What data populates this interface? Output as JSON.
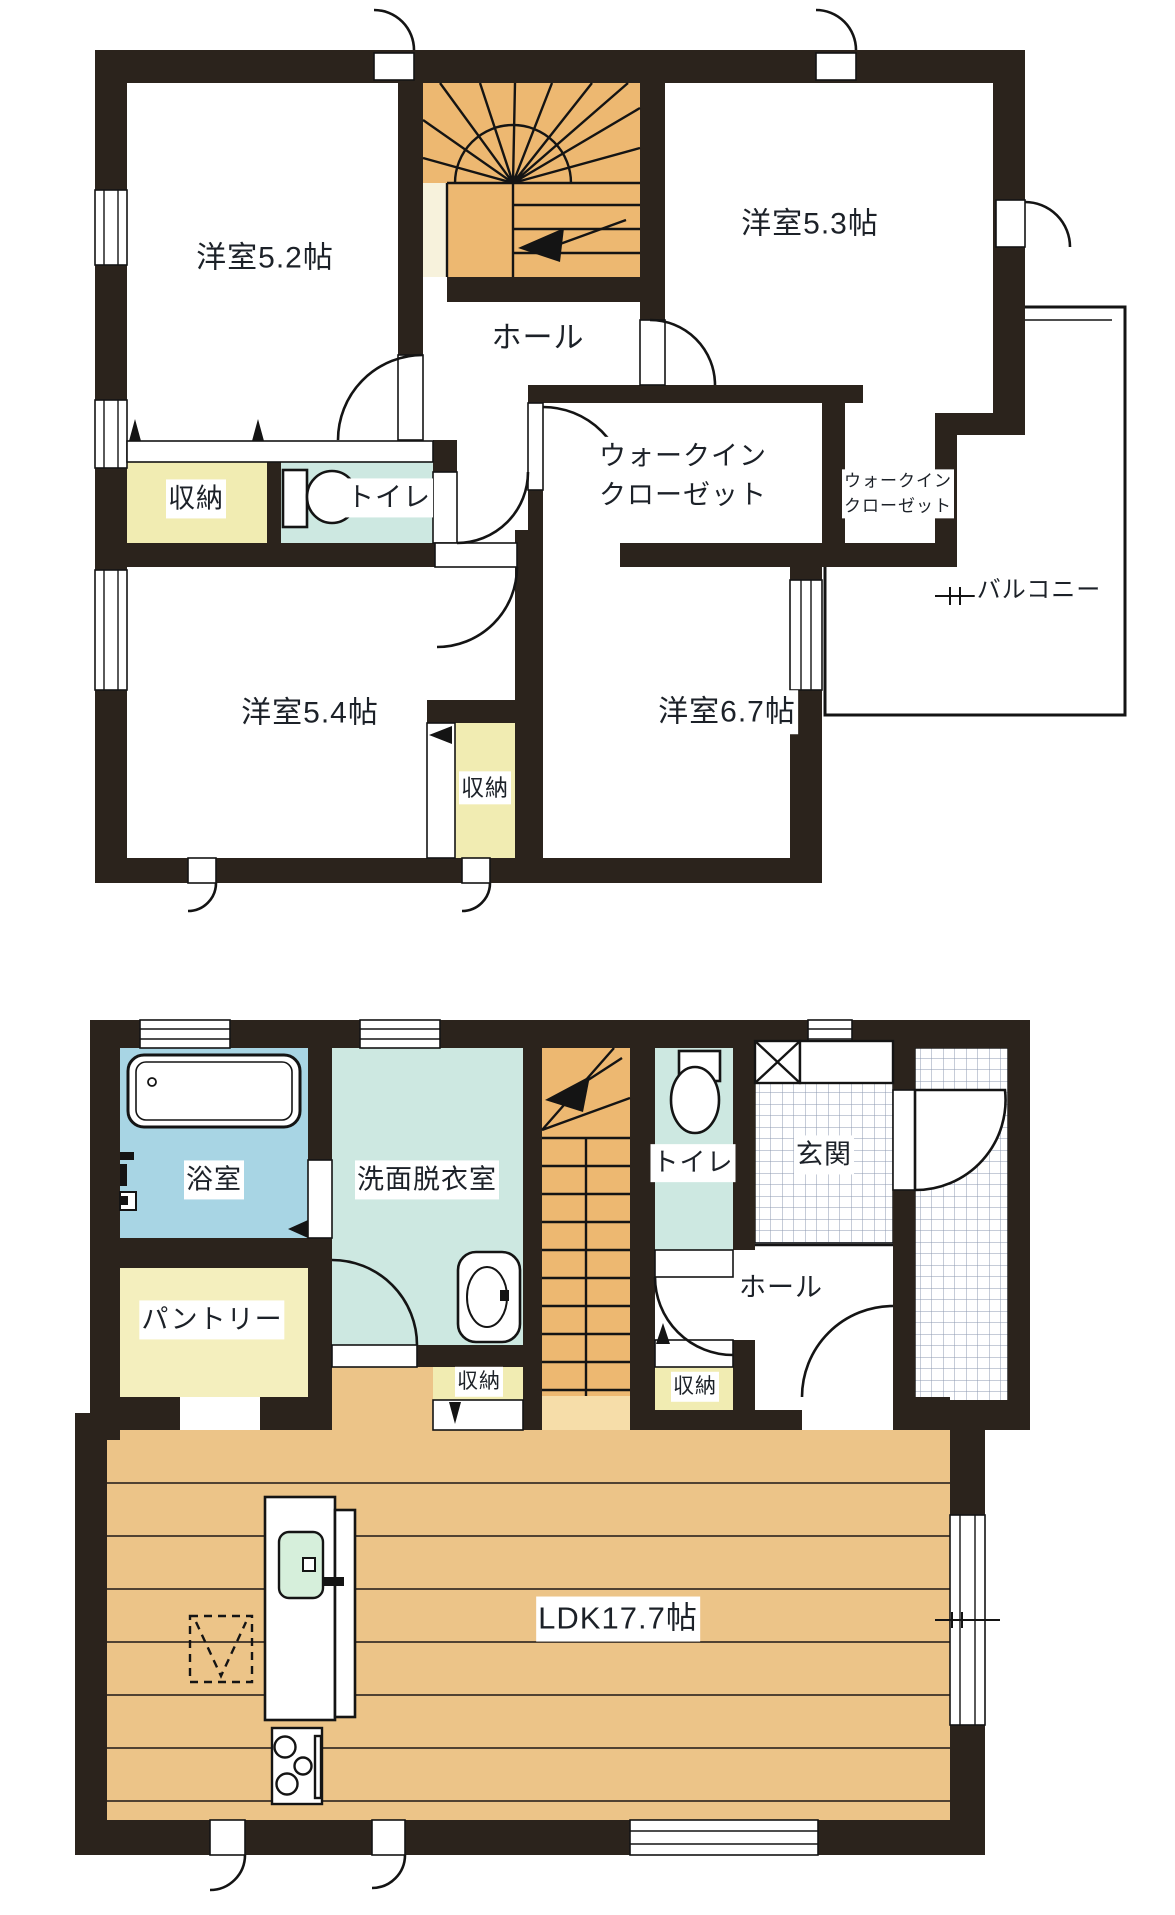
{
  "document": {
    "type": "floor-plan",
    "floors": [
      "2F",
      "1F"
    ]
  },
  "colors": {
    "wall": "#2b231c",
    "ink": "#1c2128",
    "line": "#141414",
    "stair": "#edb871",
    "stair-light": "#f6dda9",
    "floor": "#ecc488",
    "storage": "#f1ecb2",
    "pantry": "#f4efbe",
    "water": "#cde8e1",
    "bath": "#a8d5e4",
    "sink": "#d6efdb",
    "cream": "#f7f2dc",
    "tile": "#8e9ab0"
  },
  "floor2": {
    "rooms": [
      {
        "id": "western-room-5-2",
        "label": "洋室5.2帖"
      },
      {
        "id": "western-room-5-3",
        "label": "洋室5.3帖"
      },
      {
        "id": "hall",
        "label": "ホール"
      },
      {
        "id": "storage-left",
        "label": "収納"
      },
      {
        "id": "toilet",
        "label": "トイレ"
      },
      {
        "id": "walkin-closet-large",
        "label": "ウォークイン\nクローゼット"
      },
      {
        "id": "walkin-closet-small",
        "label": "ウォークイン\nクローゼット"
      },
      {
        "id": "western-room-5-4",
        "label": "洋室5.4帖"
      },
      {
        "id": "western-room-6-7",
        "label": "洋室6.7帖"
      },
      {
        "id": "storage-bottom",
        "label": "収納"
      },
      {
        "id": "balcony",
        "label": "バルコニー"
      }
    ],
    "fixtures": [
      "staircase-fan",
      "toilet-icon",
      "closet-fold-marks",
      "balcony-railing"
    ]
  },
  "floor1": {
    "rooms": [
      {
        "id": "bathroom",
        "label": "浴室"
      },
      {
        "id": "washroom",
        "label": "洗面脱衣室"
      },
      {
        "id": "toilet",
        "label": "トイレ"
      },
      {
        "id": "entrance",
        "label": "玄関"
      },
      {
        "id": "pantry",
        "label": "パントリー"
      },
      {
        "id": "hall",
        "label": "ホール"
      },
      {
        "id": "storage-left",
        "label": "収納"
      },
      {
        "id": "storage-right",
        "label": "収納"
      },
      {
        "id": "ldk",
        "label": "LDK17.7帖"
      }
    ],
    "fixtures": [
      "bathtub-icon",
      "washbasin-icon",
      "toilet-icon",
      "staircase-straight",
      "shoe-cabinet-x",
      "entrance-tiles",
      "porch-tiles",
      "kitchen-island",
      "kitchen-sink-icon",
      "stove-icon",
      "refrigerator-dashed-space"
    ]
  }
}
